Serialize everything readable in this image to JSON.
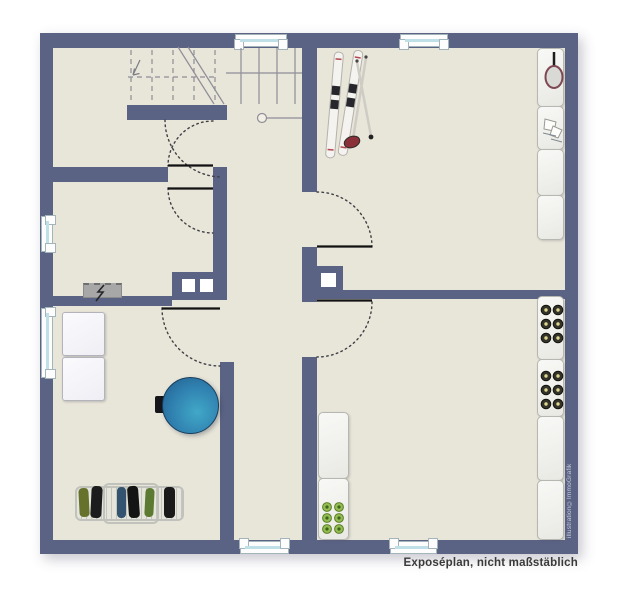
{
  "caption": "Exposéplan, nicht maßstäblich",
  "watermark": "illustration©ImmoGrafik",
  "colors": {
    "wall": "#5b6385",
    "floor": "#e8e5d9",
    "background": "#ffffff",
    "window_glass": "#bfe0e6",
    "door_swing_arc": "#3f4046",
    "door_leaf": "#121212",
    "stair_lines": "#8e8e97",
    "boiler_blue": "#2f7fae",
    "bottle_dark": "#34332a",
    "bottle_green": "#93bd55",
    "panel_gray": "#a7a7a7"
  },
  "objects": [
    "staircase",
    "skis",
    "ski-poles",
    "tennis-racket",
    "ice-skates",
    "sports-shelf",
    "wine-bottle-shelf-right",
    "wine-bottle-shelf-left",
    "wine-bottles",
    "washing-machine",
    "tumble-dryer",
    "boiler",
    "drying-rack-with-laundry",
    "electrical-panel",
    "chimney-flues",
    "windows",
    "door-swings"
  ]
}
